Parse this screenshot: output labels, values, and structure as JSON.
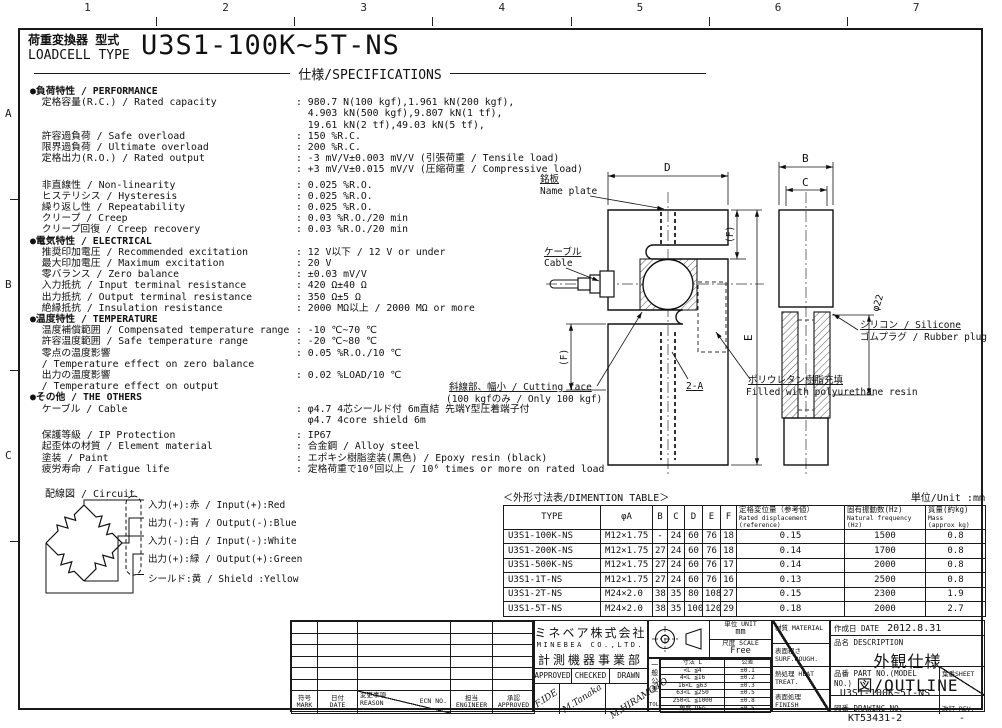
{
  "sheet": {
    "border_numbers": [
      "1",
      "2",
      "3",
      "4",
      "5",
      "6",
      "7"
    ],
    "border_letters": [
      "A",
      "B",
      "C"
    ],
    "title_jp": "荷重変換器 型式",
    "title_en": "LOADCELL TYPE",
    "model": "U3S1-100K~5T-NS",
    "spec_heading": "仕様/SPECIFICATIONS"
  },
  "specs": {
    "rows": [
      {
        "t": "sec",
        "label": "●負荷特性 / PERFORMANCE"
      },
      {
        "t": "row",
        "label": "  定格容量(R.C.) / Rated capacity",
        "value": ": 980.7 N(100 kgf),1.961 kN(200 kgf),\n  4.903 kN(500 kgf),9.807 kN(1 tf),\n  19.61 kN(2 tf),49.03 kN(5 tf),"
      },
      {
        "t": "row",
        "label": "  許容過負荷 / Safe overload",
        "value": ": 150 %R.C."
      },
      {
        "t": "row",
        "label": "  限界過負荷 / Ultimate overload",
        "value": ": 200 %R.C."
      },
      {
        "t": "row",
        "label": "  定格出力(R.O.) / Rated output",
        "value": ": -3 mV/V±0.003 mV/V (引張荷重 / Tensile load)\n: +3 mV/V±0.015 mV/V (圧縮荷重 / Compressive load)"
      },
      {
        "t": "gap"
      },
      {
        "t": "row",
        "label": "  非直線性 / Non-linearity",
        "value": ": 0.025 %R.O."
      },
      {
        "t": "row",
        "label": "  ヒステリシス / Hysteresis",
        "value": ": 0.025 %R.O."
      },
      {
        "t": "row",
        "label": "  繰り返し性 / Repeatability",
        "value": ": 0.025 %R.O."
      },
      {
        "t": "row",
        "label": "  クリープ / Creep",
        "value": ": 0.03 %R.O./20 min"
      },
      {
        "t": "row",
        "label": "  クリープ回復 / Creep recovery",
        "value": ": 0.03 %R.O./20 min"
      },
      {
        "t": "sec",
        "label": "●電気特性 / ELECTRICAL"
      },
      {
        "t": "row",
        "label": "  推奨印加電圧 / Recommended excitation",
        "value": ": 12 V以下 / 12 V or under"
      },
      {
        "t": "row",
        "label": "  最大印加電圧 / Maximum excitation",
        "value": ": 20 V"
      },
      {
        "t": "row",
        "label": "  零バランス / Zero balance",
        "value": ": ±0.03 mV/V"
      },
      {
        "t": "row",
        "label": "  入力抵抗 / Input terminal resistance",
        "value": ": 420 Ω±40 Ω"
      },
      {
        "t": "row",
        "label": "  出力抵抗 / Output terminal resistance",
        "value": ": 350 Ω±5 Ω"
      },
      {
        "t": "row",
        "label": "  絶縁抵抗 / Insulation resistance",
        "value": ": 2000 MΩ以上 / 2000 MΩ or more"
      },
      {
        "t": "sec",
        "label": "●温度特性 / TEMPERATURE"
      },
      {
        "t": "row",
        "label": "  温度補償範囲 / Compensated temperature range",
        "value": ": -10 ℃~70 ℃"
      },
      {
        "t": "row",
        "label": "  許容温度範囲 / Safe temperature range",
        "value": ": -20 ℃~80 ℃"
      },
      {
        "t": "row",
        "label": "  零点の温度影響\n  / Temperature effect on zero balance",
        "value": ": 0.05 %R.O./10 ℃"
      },
      {
        "t": "row",
        "label": "  出力の温度影響\n  / Temperature effect on output",
        "value": ": 0.02 %LOAD/10 ℃"
      },
      {
        "t": "sec",
        "label": "●その他 / THE OTHERS"
      },
      {
        "t": "row",
        "label": "  ケーブル / Cable",
        "value": ": φ4.7 4芯シールド付 6m直結 先端Y型圧着端子付\n  φ4.7 4core shield 6m"
      },
      {
        "t": "gap"
      },
      {
        "t": "row",
        "label": "  保護等級 / IP Protection",
        "value": ": IP67"
      },
      {
        "t": "row",
        "label": "  起歪体の材質 / Element material",
        "value": ": 合金鋼 / Alloy steel"
      },
      {
        "t": "row",
        "label": "  塗装 / Paint",
        "value": ": エポキシ樹脂塗装(黒色) / Epoxy resin (black)"
      },
      {
        "t": "row",
        "label": "  疲労寿命 / Fatigue life",
        "value": ": 定格荷重で10⁶回以上 / 10⁶ times or more on rated load"
      }
    ]
  },
  "circuit": {
    "title": "配線図 / Circuit",
    "wires": [
      "入力(+):赤 / Input(+):Red",
      "出力(-):青 / Output(-):Blue",
      "入力(-):白 / Input(-):White",
      "出力(+):緑 / Output(+):Green",
      "シールド:黄 / Shield :Yellow"
    ]
  },
  "drawing": {
    "labels": {
      "name_plate_jp": "銘板",
      "name_plate_en": "Name plate",
      "cable_jp": "ケーブル",
      "cable_en": "Cable",
      "dim_d": "D",
      "dim_b": "B",
      "dim_c": "C",
      "dim_e": "E",
      "dim_f_top": "(F)",
      "dim_f_bottom": "(F)",
      "dia22": "φ22",
      "two_a": "2-A",
      "silicone_jp": "シリコン / Silicone",
      "silicone_en": "ゴムプラグ / Rubber plug",
      "cutting_jp": "斜線部、幅小 / Cutting face",
      "cutting_en": "(100 kgfのみ / Only 100 kgf)",
      "resin_jp": "ポリウレタン樹脂充填",
      "resin_en": "Filled with polyurethane resin"
    }
  },
  "dimension_table": {
    "title": "＜外形寸法表/DIMENTION TABLE＞",
    "unit_note": "単位/Unit :mm",
    "columns": [
      {
        "main": "TYPE"
      },
      {
        "main": "φA"
      },
      {
        "main": "B"
      },
      {
        "main": "C"
      },
      {
        "main": "D"
      },
      {
        "main": "E"
      },
      {
        "main": "F"
      },
      {
        "main": "定格変位量（参考値）",
        "sub": "Rated displacement\n(reference)"
      },
      {
        "main": "固有振動数(Hz)",
        "sub": "Natural frequency\n(Hz)"
      },
      {
        "main": "質量(約kg)",
        "sub": "Mass\n(approx kg)"
      }
    ],
    "rows": [
      [
        "U3S1-100K-NS",
        "M12×1.75",
        "-",
        "24",
        "60",
        "76",
        "18",
        "0.15",
        "1500",
        "0.8"
      ],
      [
        "U3S1-200K-NS",
        "M12×1.75",
        "27",
        "24",
        "60",
        "76",
        "18",
        "0.14",
        "1700",
        "0.8"
      ],
      [
        "U3S1-500K-NS",
        "M12×1.75",
        "27",
        "24",
        "60",
        "76",
        "17",
        "0.14",
        "2000",
        "0.8"
      ],
      [
        "U3S1-1T-NS",
        "M12×1.75",
        "27",
        "24",
        "60",
        "76",
        "16",
        "0.13",
        "2500",
        "0.8"
      ],
      [
        "U3S1-2T-NS",
        "M24×2.0",
        "38",
        "35",
        "80",
        "108",
        "27",
        "0.15",
        "2300",
        "1.9"
      ],
      [
        "U3S1-5T-NS",
        "M24×2.0",
        "38",
        "35",
        "100",
        "120",
        "29",
        "0.18",
        "2000",
        "2.7"
      ]
    ]
  },
  "title_block": {
    "revision": {
      "mark_jp": "符号",
      "mark_en": "MARK",
      "date_jp": "日付",
      "date_en": "DATE",
      "reason_jp": "変更事項",
      "reason_en": "REASON",
      "ecn": "ECN NO.",
      "engineer_jp": "担当",
      "engineer_en": "ENGINEER",
      "approved_jp": "承認",
      "approved_en": "APPROVED"
    },
    "company": {
      "name_jp": "ミネベア株式会社",
      "name_en": "MINEBEA CO.,LTD.",
      "division": "計測機器事業部"
    },
    "signatures": {
      "approved_label": "APPROVED",
      "checked_label": "CHECKED",
      "drawn_label": "DRAWN",
      "approved": "F.IDE",
      "checked": "M.Tanaka",
      "drawn": "M.HIRAMOTO"
    },
    "unit": {
      "label": "単位 UNIT",
      "value": "mm",
      "scale_label": "尺度 SCALE",
      "scale_value": "Free"
    },
    "tolerance": {
      "side_label": "一般公差",
      "side_label2": "TOL",
      "col1": "寸法 L",
      "col2": "公差",
      "rows": [
        [
          "<L ≦4",
          "±0.1"
        ],
        [
          "4<L ≦16",
          "±0.2"
        ],
        [
          "16<L ≦63",
          "±0.3"
        ],
        [
          "63<L ≦250",
          "±0.5"
        ],
        [
          "250<L ≦1000",
          "±0.8"
        ],
        [
          "角度 DEG",
          "±0.5"
        ]
      ]
    },
    "finish": {
      "material": "材質 MATERIAL",
      "surf": "表面粗さ SURF.ROUGH.",
      "heat": "熱処理 HEAT TREAT.",
      "finish": "表面処理 FINISH"
    },
    "info": {
      "date_label": "作成日 DATE",
      "date_value": "2012.8.31",
      "desc_label": "品名 DESCRIPTION",
      "desc_value": "外観仕様図/OUTLINE",
      "part_label": "品番 PART NO.(MODEL NO.)",
      "part_value": "U3S1-100K~5T-NS",
      "sheet_label": "葉番SHEET",
      "drawing_label": "図番 DRAWING NO.",
      "drawing_value": "KT53431-2",
      "rev_label": "改訂 REV.",
      "rev_value": "-"
    }
  }
}
